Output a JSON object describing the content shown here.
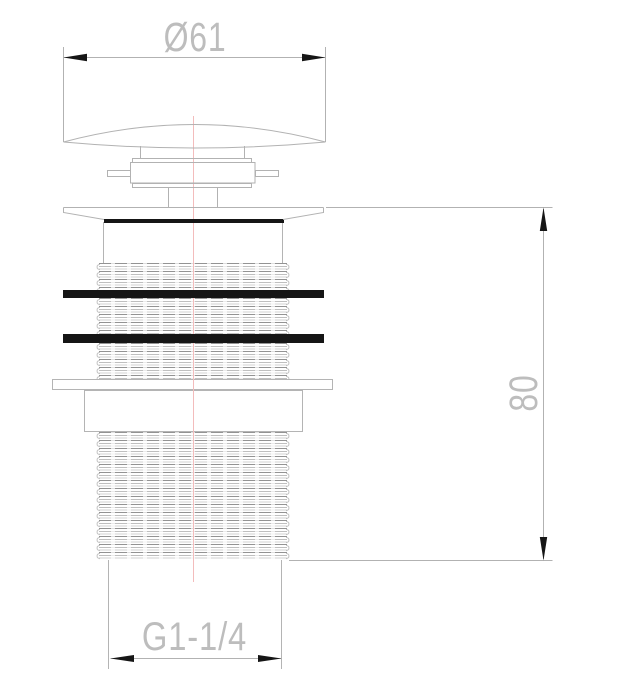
{
  "drawing": {
    "type": "technical-drawing",
    "subject": "pop-up basin waste fitting, front elevation",
    "dimensions": {
      "diameter_label": "Ø61",
      "height_label": "80",
      "thread_label": "G1-1/4"
    },
    "colors": {
      "background": "#ffffff",
      "outline": "#b2b2b2",
      "solid_black": "#151515",
      "centerline": "#f3bcbc",
      "dimension_text": "#bdbdbd"
    }
  }
}
